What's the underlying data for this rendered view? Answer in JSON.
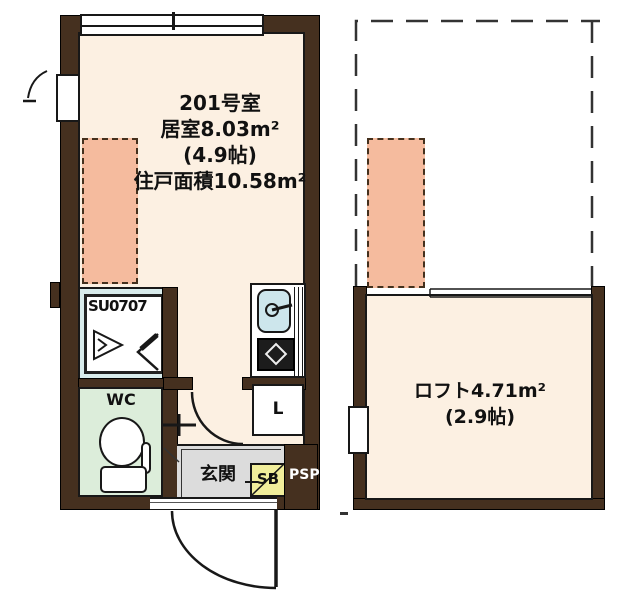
{
  "floor_plan": {
    "main_unit": {
      "title": "201号室",
      "living_area": "居室8.03m²",
      "living_area_tatami": "(4.9帖)",
      "total_unit_area": "住戸面積10.58m²",
      "labels": {
        "shower_unit": "SU0707",
        "wc": "WC",
        "entrance": "玄関",
        "shoe_box": "SB",
        "pipe_space": "PSP",
        "washer": "L"
      }
    },
    "loft": {
      "area": "ロフト4.71m²",
      "tatami": "(2.9帖)"
    },
    "colors": {
      "wall_brown": "#45301f",
      "floor_cream": "#fcf0e2",
      "futon_pink": "#f5bb9e",
      "wc_green": "#dcedda",
      "entrance_gray": "#dcdcdc",
      "shoe_box_yellow": "#f1ee9b",
      "shower_unit_cyan": "#d9ecec",
      "sink_blue": "#cde6ec"
    }
  }
}
